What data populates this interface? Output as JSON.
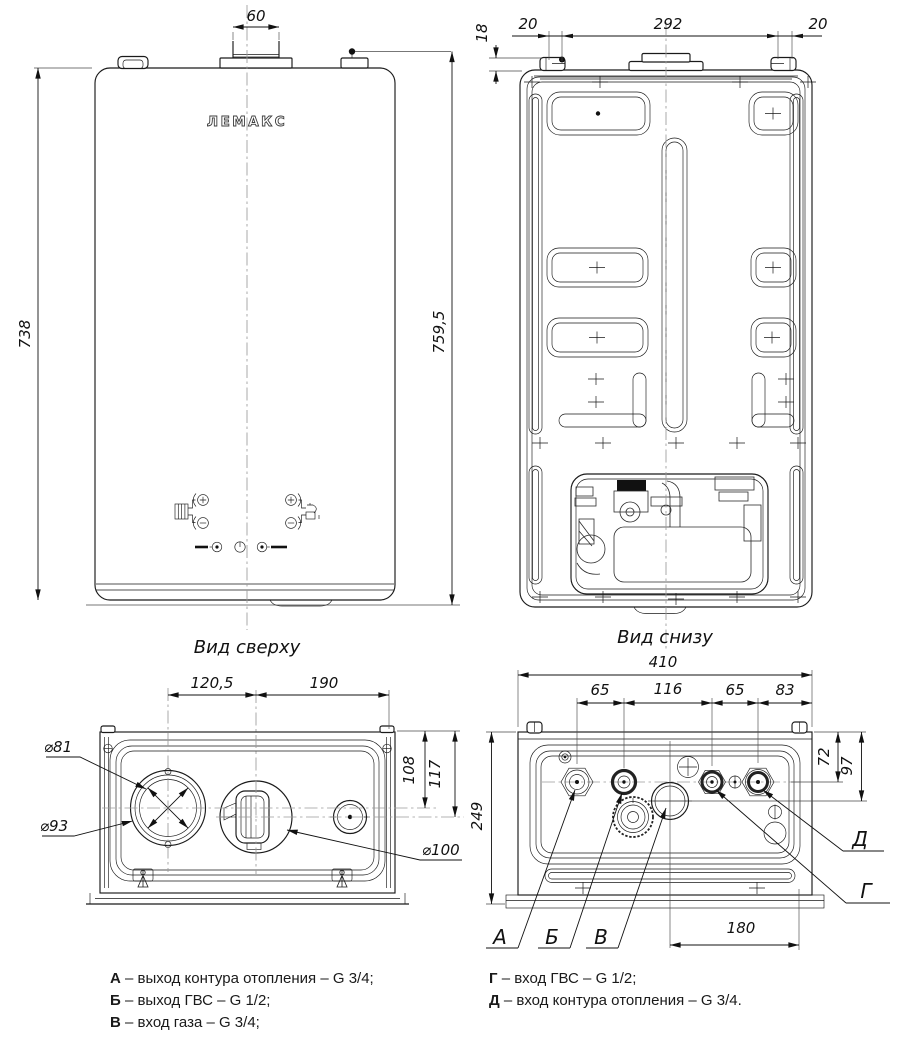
{
  "brand": "ЛЕМАКС",
  "views": {
    "front": {
      "dims": {
        "flue_width": "60",
        "height_body": "738",
        "height_overall": "759,5"
      }
    },
    "rear": {
      "dims": {
        "ledge_height": "18",
        "left_offset": "20",
        "bracket_span": "292",
        "right_offset": "20"
      }
    },
    "top": {
      "caption": "Вид сверху",
      "dims": {
        "flue_center_offset": "120,5",
        "air_center_offset": "190",
        "flue_depth": "108",
        "air_depth": "117",
        "flue_inner_dia": "⌀81",
        "flue_outer_dia": "⌀93",
        "air_dia": "⌀100"
      }
    },
    "bottom": {
      "caption": "Вид снизу",
      "dims": {
        "width": "410",
        "span_a_b": "65",
        "span_b_g": "116",
        "span_g_d": "65",
        "span_d_edge": "83",
        "row_depth": "72",
        "gas_depth": "97",
        "overall_depth": "249",
        "gas_offset": "180"
      },
      "ports": {
        "a": "А",
        "b": "Б",
        "v": "В",
        "g": "Г",
        "d": "Д"
      }
    }
  },
  "legend": {
    "left": [
      {
        "key": "А",
        "text": "– выход контура отопления – G 3/4;"
      },
      {
        "key": "Б",
        "text": "– выход ГВС – G 1/2;"
      },
      {
        "key": "В",
        "text": "– вход газа – G 3/4;"
      }
    ],
    "right": [
      {
        "key": "Г",
        "text": "– вход ГВС – G 1/2;"
      },
      {
        "key": "Д",
        "text": "– вход контура отопления – G 3/4."
      }
    ]
  },
  "colors": {
    "line": "#1a1a1a",
    "centerline": "#9a9a9a",
    "background": "#ffffff"
  }
}
